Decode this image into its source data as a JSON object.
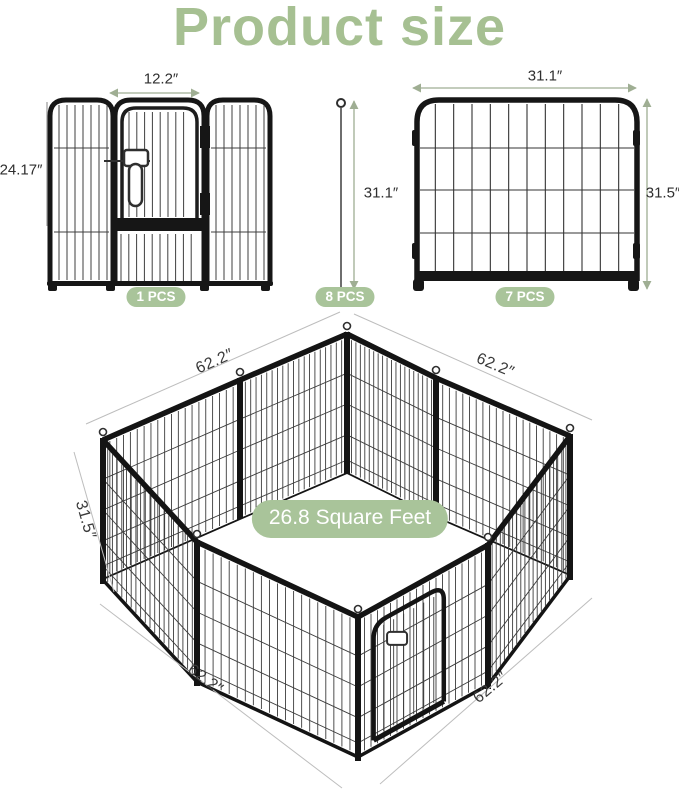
{
  "title": "Product size",
  "colors": {
    "accent_green": "#a6c092",
    "badge_green": "#a9c49a",
    "arrow_green": "#9fae93"
  },
  "door_panel_figure": {
    "width_label": "12.2″",
    "height_label": "24.17″",
    "count_label": "1 PCS"
  },
  "stake_figure": {
    "height_label": "31.1″",
    "count_label": "8 PCS"
  },
  "panel_figure": {
    "width_label": "31.1″",
    "height_label": "31.5″",
    "count_label": "7 PCS"
  },
  "assembled_figure": {
    "area_label": "26.8 Square Feet",
    "side_top_left_label": "62.2″",
    "side_top_right_label": "62.2″",
    "height_label": "31.5″",
    "side_bottom_left_label": "62.2″",
    "side_bottom_right_label": "62.2″"
  }
}
